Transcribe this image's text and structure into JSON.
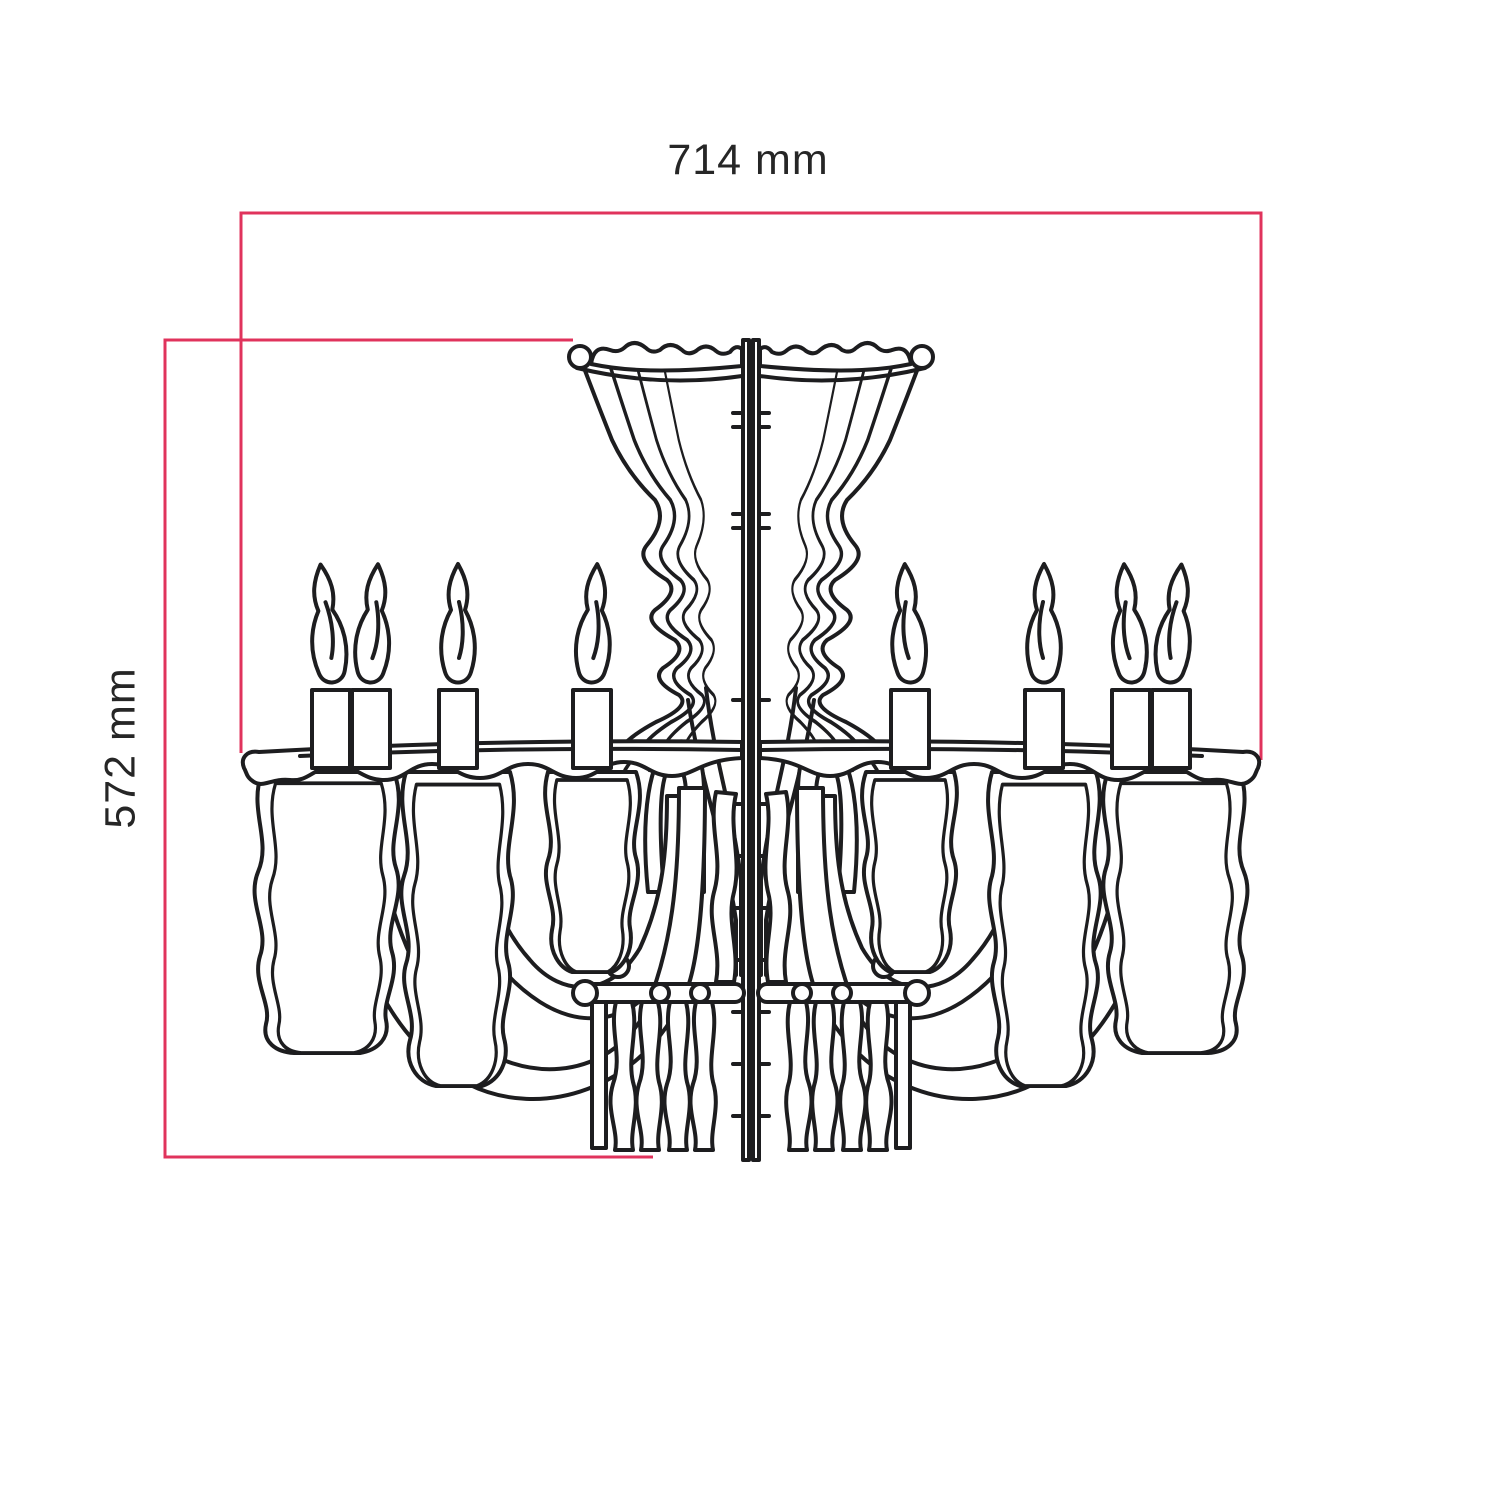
{
  "diagram": {
    "type": "technical-dimension-drawing",
    "subject": "chandelier front-view line drawing",
    "width_dimension": {
      "label": "714 mm",
      "value": 714,
      "unit": "mm"
    },
    "height_dimension": {
      "label": "572 mm",
      "value": 572,
      "unit": "mm"
    },
    "colors": {
      "dimension_line": "#e0335c",
      "outline": "#1d1d1f",
      "label_text": "#262626",
      "background": "#ffffff"
    }
  }
}
